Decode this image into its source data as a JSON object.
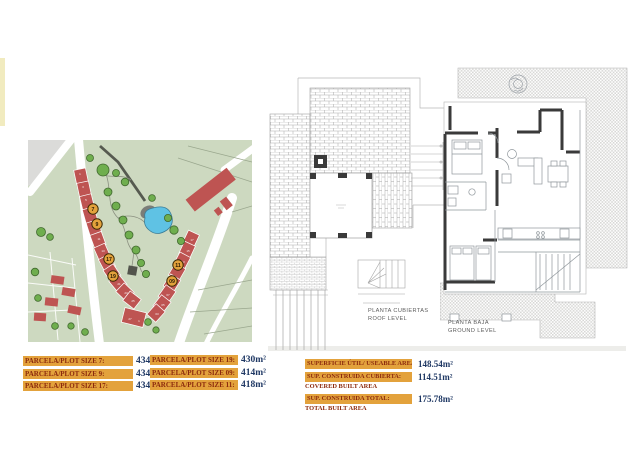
{
  "colors": {
    "accent_orange": "#E3A23C",
    "table_label_text": "#8C2A0D",
    "table_value_text": "#1F3864",
    "map_green": "#CDD9C0",
    "building_red": "#BE5452",
    "pond_blue": "#5FC2E4",
    "tree_green": "#6FAE4E"
  },
  "site_plan": {
    "markers": [
      {
        "label": "7"
      },
      {
        "label": "9"
      },
      {
        "label": "17"
      },
      {
        "label": "19"
      },
      {
        "label": "11"
      },
      {
        "label": "09"
      }
    ],
    "left_strip_numbers": [
      "1",
      "3",
      "5",
      "11",
      "13",
      "15",
      "21",
      "23",
      "25"
    ],
    "bottom_house_numbers": [
      "27",
      "1"
    ],
    "right_strip_numbers": [
      "17",
      "15",
      "13",
      "07",
      "05",
      "03"
    ]
  },
  "floor_plans": {
    "roof": {
      "title_es": "PLANTA CUBIERTAS",
      "title_en": "ROOF LEVEL"
    },
    "ground": {
      "title_es": "PLANTA BAJA",
      "title_en": "GROUND LEVEL"
    }
  },
  "plot_table": {
    "col1": [
      {
        "label": "PARCELA/PLOT SIZE 7:",
        "value": "434m²"
      },
      {
        "label": "PARCELA/PLOT SIZE 9:",
        "value": "434m²"
      },
      {
        "label": "PARCELA/PLOT SIZE 17:",
        "value": "434m²"
      }
    ],
    "col2": [
      {
        "label": "PARCELA/PLOT SIZE 19:",
        "value": "430m²"
      },
      {
        "label": "PARCELA/PLOT SIZE 09:",
        "value": "414m²"
      },
      {
        "label": "PARCELA/PLOT SIZE 11:",
        "value": "418m²"
      }
    ]
  },
  "area_table": {
    "rows": [
      {
        "label": "SUPERFICIE ÚTIL/ USEABLE AREA:",
        "sublabel": "",
        "value": "148.54m²"
      },
      {
        "label": "SUP. CONSTRUIDA CUBIERTA:",
        "sublabel": "COVERED BUILT AREA",
        "value": "114.51m²"
      },
      {
        "label": "SUP. CONSTRUIDA TOTAL:",
        "sublabel": "TOTAL BUILT AREA",
        "value": "175.78m²"
      }
    ]
  }
}
